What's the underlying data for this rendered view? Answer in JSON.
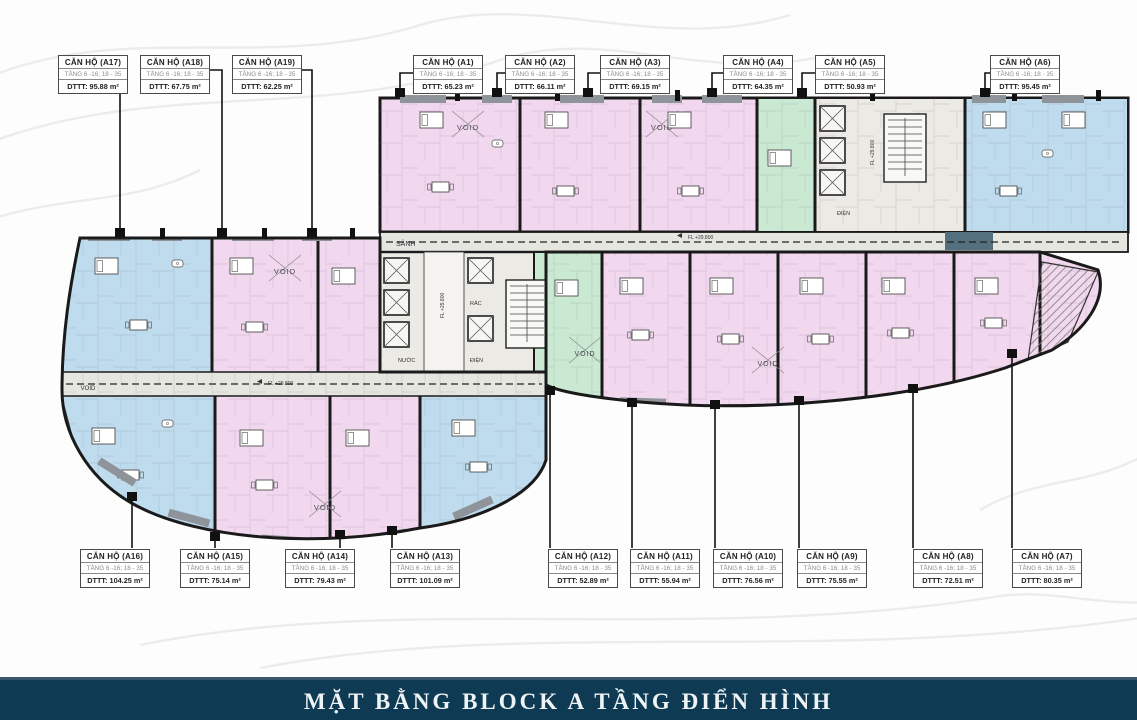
{
  "title_bar": {
    "text": "MẶT BẰNG BLOCK A TẦNG ĐIỂN HÌNH",
    "background": "#0e3a53",
    "text_color": "#eef3f6"
  },
  "plan_labels": {
    "lobby": "SẢNH",
    "void": "VOID",
    "electric": "ĐIỆN",
    "water": "NƯỚC",
    "trash": "RÁC",
    "level": "FL +29.800"
  },
  "colors": {
    "apartment_pink": "#f2d8ef",
    "apartment_blue": "#bedcee",
    "apartment_green": "#c9e9d2",
    "corridor_gray": "#e6e6e1",
    "wall_black": "#1a1a1a",
    "navy": "#0e3a53"
  },
  "units": [
    {
      "id": "A17",
      "title": "CĂN HỘ (A17)",
      "floors": "TẦNG 6 -16; 18 - 35",
      "area": "DTTT: 95.88 m²"
    },
    {
      "id": "A18",
      "title": "CĂN HỘ (A18)",
      "floors": "TẦNG 6 -16; 18 - 35",
      "area": "DTTT: 67.75 m²"
    },
    {
      "id": "A19",
      "title": "CĂN HỘ (A19)",
      "floors": "TẦNG 6 -16; 18 - 35",
      "area": "DTTT: 62.25 m²"
    },
    {
      "id": "A1",
      "title": "CĂN HỘ (A1)",
      "floors": "TẦNG 6 -16; 18 - 35",
      "area": "DTTT: 65.23 m²"
    },
    {
      "id": "A2",
      "title": "CĂN HỘ (A2)",
      "floors": "TẦNG 6 -16; 18 - 35",
      "area": "DTTT: 66.11 m²"
    },
    {
      "id": "A3",
      "title": "CĂN HỘ (A3)",
      "floors": "TẦNG 6 -16; 18 - 35",
      "area": "DTTT: 69.15 m²"
    },
    {
      "id": "A4",
      "title": "CĂN HỘ (A4)",
      "floors": "TẦNG 6 -16; 18 - 35",
      "area": "DTTT: 64.35 m²"
    },
    {
      "id": "A5",
      "title": "CĂN HỘ (A5)",
      "floors": "TẦNG 6 -16; 18 - 35",
      "area": "DTTT: 50.93 m²"
    },
    {
      "id": "A6",
      "title": "CĂN HỘ (A6)",
      "floors": "TẦNG 6 -16; 18 - 35",
      "area": "DTTT: 95.45 m²"
    },
    {
      "id": "A16",
      "title": "CĂN HỘ (A16)",
      "floors": "TẦNG 6 -16; 18 - 35",
      "area": "DTTT: 104.25 m²"
    },
    {
      "id": "A15",
      "title": "CĂN HỘ (A15)",
      "floors": "TẦNG 6 -16; 18 - 35",
      "area": "DTTT: 75.14 m²"
    },
    {
      "id": "A14",
      "title": "CĂN HỘ (A14)",
      "floors": "TẦNG 6 -16; 18 - 35",
      "area": "DTTT: 79.43 m²"
    },
    {
      "id": "A13",
      "title": "CĂN HỘ (A13)",
      "floors": "TẦNG 6 -16; 18 - 35",
      "area": "DTTT: 101.09 m²"
    },
    {
      "id": "A12",
      "title": "CĂN HỘ (A12)",
      "floors": "TẦNG 6 -16; 18 - 35",
      "area": "DTTT: 52.89 m²"
    },
    {
      "id": "A11",
      "title": "CĂN HỘ (A11)",
      "floors": "TẦNG 6 -16; 18 - 35",
      "area": "DTTT: 55.94 m²"
    },
    {
      "id": "A10",
      "title": "CĂN HỘ (A10)",
      "floors": "TẦNG 6 -16; 18 - 35",
      "area": "DTTT: 76.56 m²"
    },
    {
      "id": "A9",
      "title": "CĂN HỘ (A9)",
      "floors": "TẦNG 6 -16; 18 - 35",
      "area": "DTTT: 75.55 m²"
    },
    {
      "id": "A8",
      "title": "CĂN HỘ (A8)",
      "floors": "TẦNG 6 -16; 18 - 35",
      "area": "DTTT: 72.51 m²"
    },
    {
      "id": "A7",
      "title": "CĂN HỘ (A7)",
      "floors": "TẦNG 6 -16; 18 - 35",
      "area": "DTTT: 80.35 m²"
    }
  ]
}
